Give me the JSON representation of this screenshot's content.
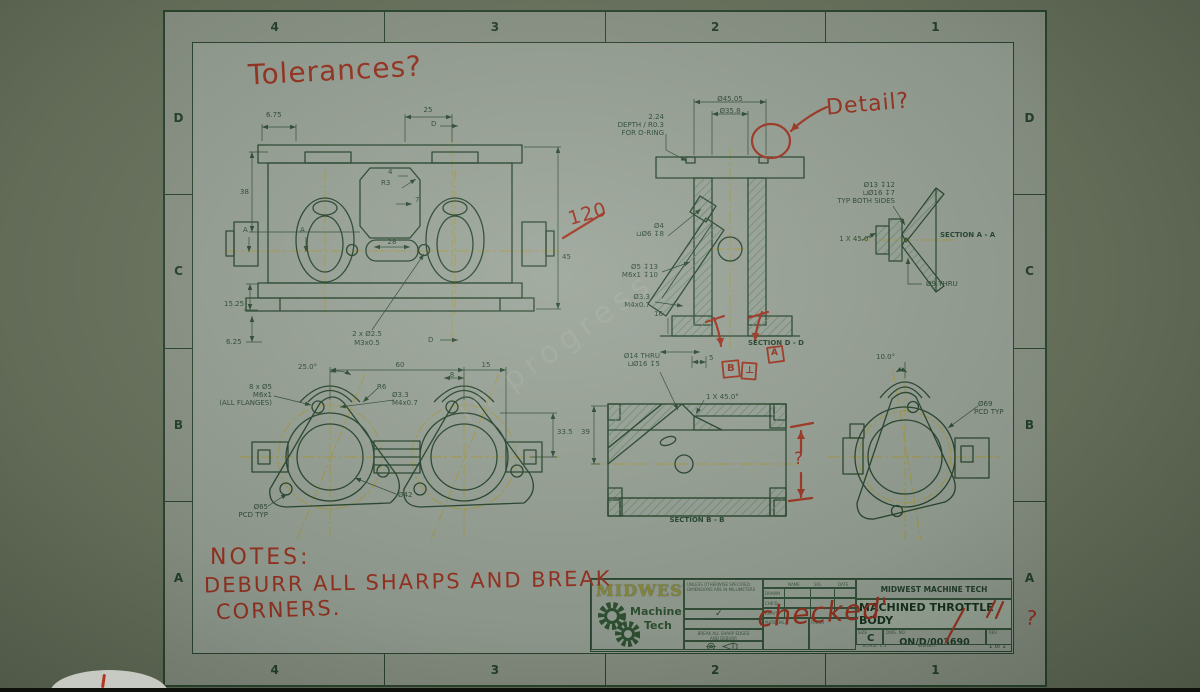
{
  "zones": {
    "cols": [
      "4",
      "3",
      "2",
      "1"
    ],
    "rows": [
      "D",
      "C",
      "B",
      "A"
    ]
  },
  "views": {
    "front": {
      "f1": "6.75",
      "f2": "25",
      "f3": "D",
      "f4": "38",
      "f5": "4",
      "f6": "R3",
      "f7": "7",
      "f8": "A",
      "f9": "A",
      "f10": "28",
      "f11": "45",
      "f12": "15.25",
      "f13": "6.25",
      "f14a": "2 x Ø2.5",
      "f14b": "M3x0.5",
      "f15": "D"
    },
    "dd": {
      "d1": "Ø45.05",
      "d2": "Ø35.8",
      "d3a": "2.24",
      "d3b": "DEPTH / R0.3",
      "d3c": "FOR O-RING",
      "d4a": "Ø4",
      "d4b": "⊔Ø6 ↧8",
      "d5a": "Ø5 ↧13",
      "d5b": "M6x1 ↧10",
      "d6a": "Ø3.3",
      "d6b": "M4x0.7",
      "d7": "16",
      "label": "SECTION D - D"
    },
    "aa": {
      "a1": "Ø13 ↧12",
      "a2": "⊔Ø16 ↧7",
      "a3": "TYP BOTH SIDES",
      "a4": "1 X 45.0°",
      "label": "SECTION A - A",
      "a5": "Ø9 THRU"
    },
    "top": {
      "t1": "25.0°",
      "t2": "60",
      "t3": "15",
      "t4": "8",
      "t5a": "8 x Ø5",
      "t5b": "M6x1",
      "t5c": "(ALL FLANGES)",
      "t6": "R6",
      "t7a": "Ø3.3",
      "t7b": "M4x0.7",
      "t8": "33.5",
      "t9": "Ø42",
      "t10a": "Ø65",
      "t10b": "PCD TYP"
    },
    "bb": {
      "b1a": "Ø14 THRU",
      "b1b": "⊔Ø16 ↧5",
      "b2": "5",
      "b3": "1 X 45.0°",
      "b4": "39",
      "label": "SECTION B - B"
    },
    "end": {
      "e1": "10.0°",
      "e2a": "Ø69",
      "e2b": "PCD TYP"
    }
  },
  "red": {
    "tolerances": "Tolerances?",
    "detail": "Detail?",
    "dim120": "120",
    "checked": "checked'",
    "q_bb": "?",
    "q_rev": "?",
    "gdt1": "B",
    "gdt2": "⊥",
    "gdt3": "A",
    "notes1": "NOTES:",
    "notes2": "DEBURR ALL SHARPS AND BREAK",
    "notes3": "CORNERS."
  },
  "tb": {
    "company": "MIDWEST MACHINE TECH",
    "part_title": "MACHINED THROTTLE BODY",
    "size_label": "SIZE",
    "size": "C",
    "dwg_label": "DWG. NO.",
    "dwg": "ON/D/003690",
    "rev_label": "REV",
    "scale": "SCALE: 1:1",
    "weight": "WEIGHT:",
    "sheet": "1 of 1",
    "logo1": "MIDWEST",
    "logo2": "Machine",
    "logo3": "Tech",
    "sp1": "UNLESS OTHERWISE SPECIFIED:",
    "sp2": "DIMENSIONS ARE IN MILLIMETERS",
    "check": "✓",
    "dns": "DO NOT SCALE DRAWING",
    "brk1": "BREAK ALL SHARP EDGES",
    "brk2": "AND DEBURR",
    "col_name": "NAME",
    "col_sig": "SIG.",
    "col_date": "DATE",
    "row1": "DRAWN",
    "row2": "CHK'D",
    "row3": "APPV'D",
    "material": "MATERIAL",
    "finish": "FINISH"
  },
  "watermark": "in progress"
}
